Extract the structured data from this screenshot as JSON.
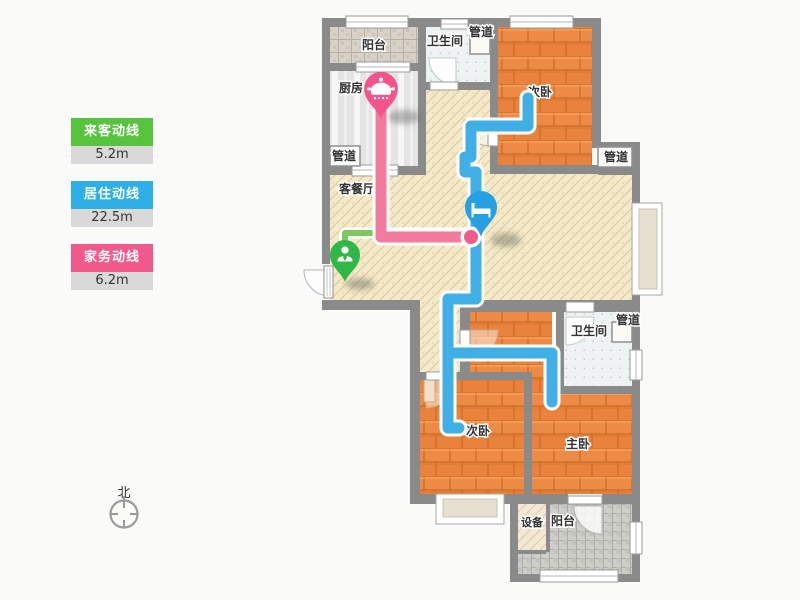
{
  "legend": {
    "items": [
      {
        "label": "来客动线",
        "value": "5.2m",
        "color": "#56C43C"
      },
      {
        "label": "居住动线",
        "value": "22.5m",
        "color": "#2FAFE8"
      },
      {
        "label": "家务动线",
        "value": "6.2m",
        "color": "#F2598A"
      }
    ]
  },
  "compass": {
    "north": "北"
  },
  "rooms": {
    "balcony_top": "阳台",
    "kitchen": "厨房",
    "bathroom_top": "卫生间",
    "pipe_top": "管道",
    "bedroom_top": "次卧",
    "pipe_right_top": "管道",
    "pipe_kitchen": "管道",
    "living_dining": "客餐厅",
    "pipe_right_mid": "管道",
    "bathroom_bottom": "卫生间",
    "bedroom_bottom": "次卧",
    "master_bedroom": "主卧",
    "equipment": "设备",
    "balcony_bottom": "阳台"
  },
  "route_colors": {
    "guest": "#7CC95F",
    "resident": "#3FAFE6",
    "housework": "#F27C9E"
  },
  "marker_colors": {
    "entry_person": "#2FB845",
    "bedroom_bed": "#279FE3",
    "kitchen_pot": "#F4538C"
  }
}
